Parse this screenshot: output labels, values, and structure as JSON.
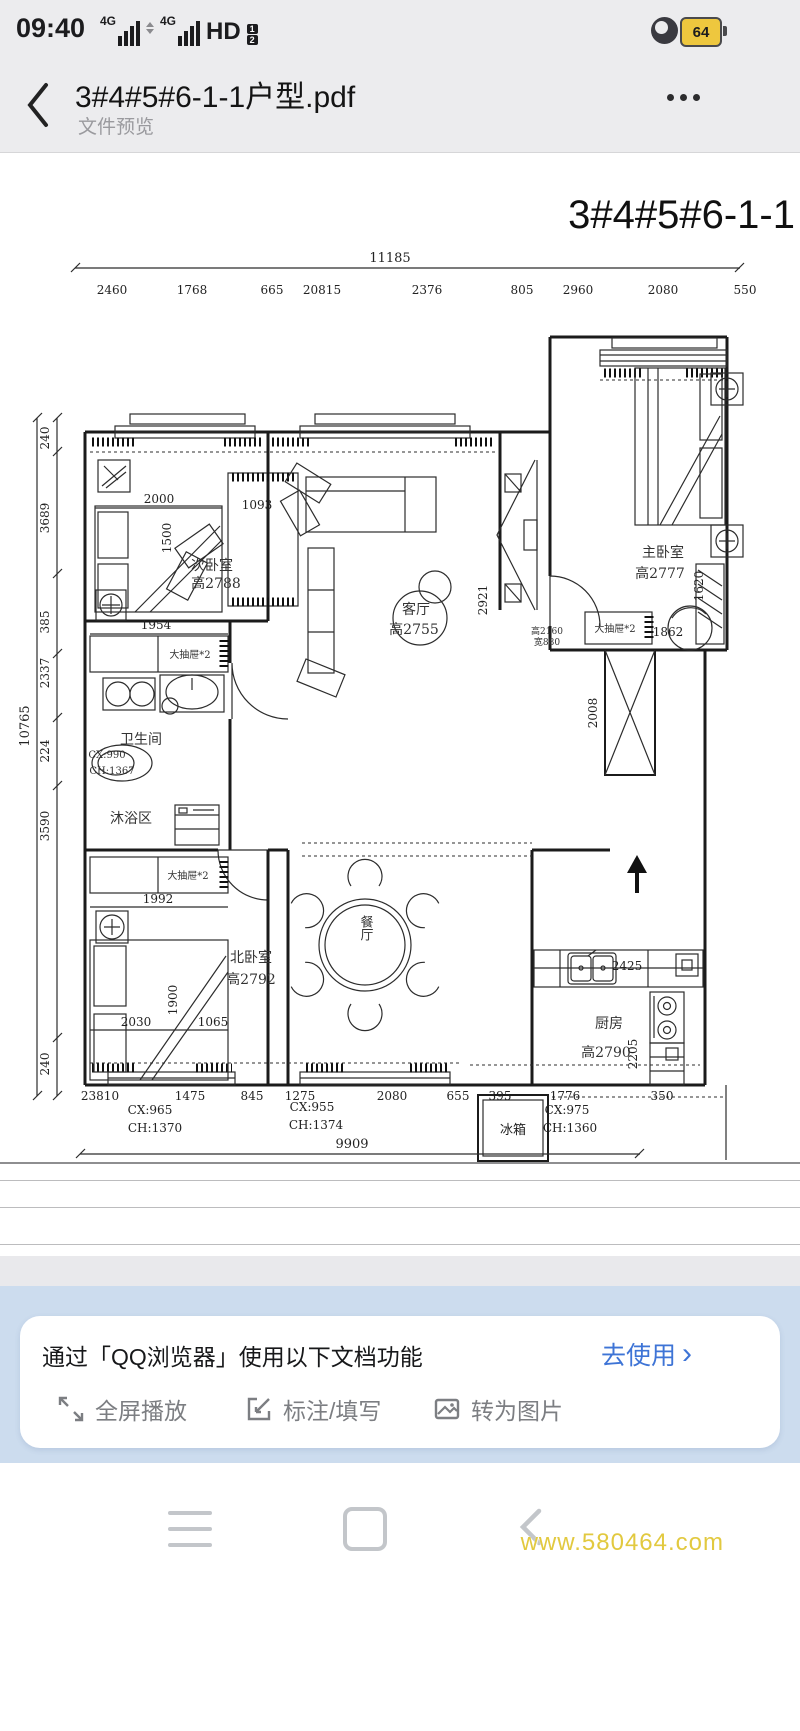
{
  "status": {
    "time": "09:40",
    "net1": "4G",
    "net2": "4G",
    "hd": "HD",
    "sim1": "1",
    "sim2": "2",
    "battery": "64"
  },
  "header": {
    "title": "3#4#5#6-1-1户型.pdf",
    "subtitle": "文件预览"
  },
  "plan": {
    "title": "3#4#5#6-1-1",
    "top_total": "11185",
    "top_dims": [
      "2460",
      "1768",
      "665",
      "20815",
      "2376",
      "805",
      "2960",
      "2080",
      "550"
    ],
    "left_total": "10765",
    "left_dims": [
      "240",
      "3689",
      "385",
      "2337",
      "224",
      "3590",
      "240"
    ],
    "bottom_dims": [
      "23810",
      "1475",
      "845",
      "1275",
      "2080",
      "655",
      "395",
      "1776",
      "350"
    ],
    "bottom_total": "9909",
    "labels": {
      "second_bedroom": "次卧室",
      "second_bedroom_h": "高2788",
      "living": "客厅",
      "living_h": "高2755",
      "master": "主卧室",
      "master_h": "高2777",
      "bath": "卫生间",
      "bath_cx": "CX:990",
      "bath_ch": "CH:1367",
      "shower": "沐浴区",
      "north_bedroom": "北卧室",
      "north_bedroom_h": "高2792",
      "dining": "餐厅",
      "kitchen": "厨房",
      "kitchen_h": "高2790",
      "fridge": "冰箱",
      "drawer": "大抽屉*2",
      "win_note1": "高2160",
      "win_note2": "宽880",
      "cx1": "CX:965",
      "ch1": "CH:1370",
      "cx2": "CX:955",
      "ch2": "CH:1374",
      "cx3": "CX:975",
      "ch3": "CH:1360"
    },
    "inner_dims": {
      "d2000": "2000",
      "d1500": "1500",
      "d1093": "1093",
      "d1954": "1954",
      "d2921": "2921",
      "d1620": "1620",
      "d1862": "1862",
      "d2008": "2008",
      "d2425": "2425",
      "d1992": "1992",
      "d1900": "1900",
      "d2030": "2030",
      "d1065": "1065",
      "d2205": "2205"
    }
  },
  "promo": {
    "message": "通过「QQ浏览器」使用以下文档功能",
    "action": "去使用",
    "chevron": "›",
    "features": [
      "全屏播放",
      "标注/填写",
      "转为图片"
    ]
  },
  "watermark": "www.580464.com"
}
